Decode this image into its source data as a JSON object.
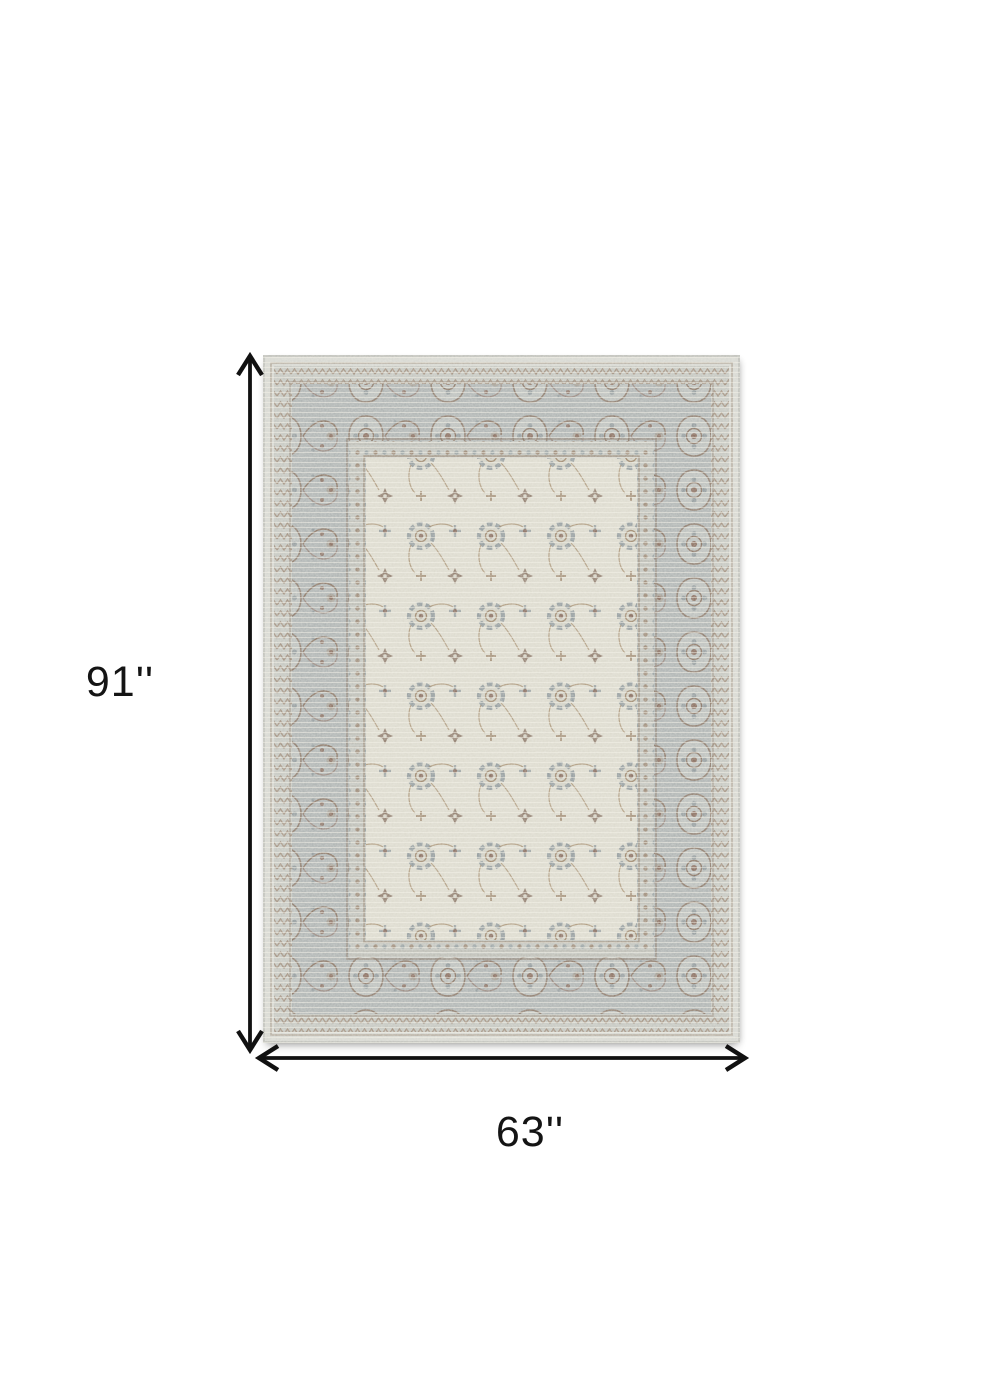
{
  "page": {
    "background_color": "#ffffff"
  },
  "annotation": {
    "height_label": "91''",
    "width_label": "63''",
    "arrow_color": "#111111",
    "text_color": "#141414"
  },
  "product_image": {
    "type": "area-rug",
    "style": "vintage-distressed-oriental",
    "orientation": "portrait",
    "palette": {
      "outer_edge": "#d8d9d3",
      "guard_band": "#c7c9c3",
      "main_border": "#b2b7b6",
      "inner_guard": "#c5c7c1",
      "field": "#dedcd0",
      "motif_brown": "#8d7365",
      "motif_gray": "#98a0a2",
      "vine_brown": "#a38a6b"
    }
  }
}
